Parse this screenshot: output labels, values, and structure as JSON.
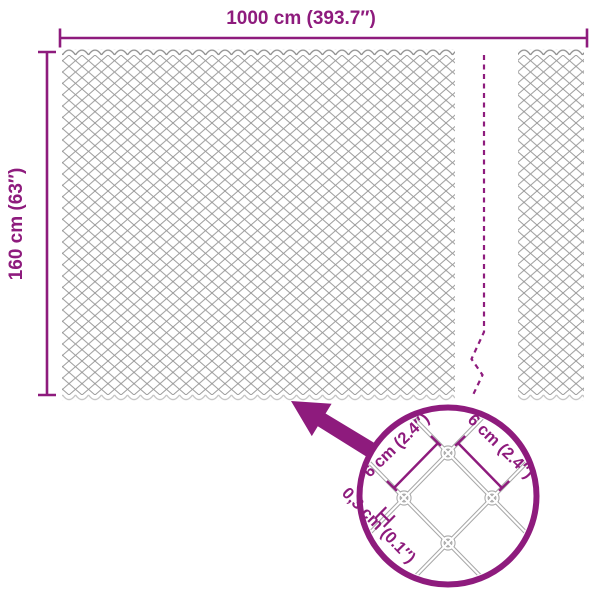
{
  "diagram": {
    "type": "product-dimension-diagram",
    "subject": "chain-link fence mesh",
    "width_dimension": {
      "label": "1000 cm (393.7″)"
    },
    "height_dimension": {
      "label": "160 cm (63″)"
    },
    "detail_view": {
      "mesh_size_left": {
        "label": "6 cm (2.4″)"
      },
      "mesh_size_right": {
        "label": "6 cm (2.4″)"
      },
      "wire_thickness": {
        "label": "0,3 cm (0.1″)"
      }
    }
  },
  "colors": {
    "accent_purple": "#8e1b7d",
    "mesh_line_gray": "#9a9a9a",
    "mesh_top_edge_gray": "#8a8a8a",
    "mesh_bottom_edge_gray": "#c2c2c2",
    "detail_wire_gray": "#a8a8a8",
    "background": "#ffffff"
  }
}
